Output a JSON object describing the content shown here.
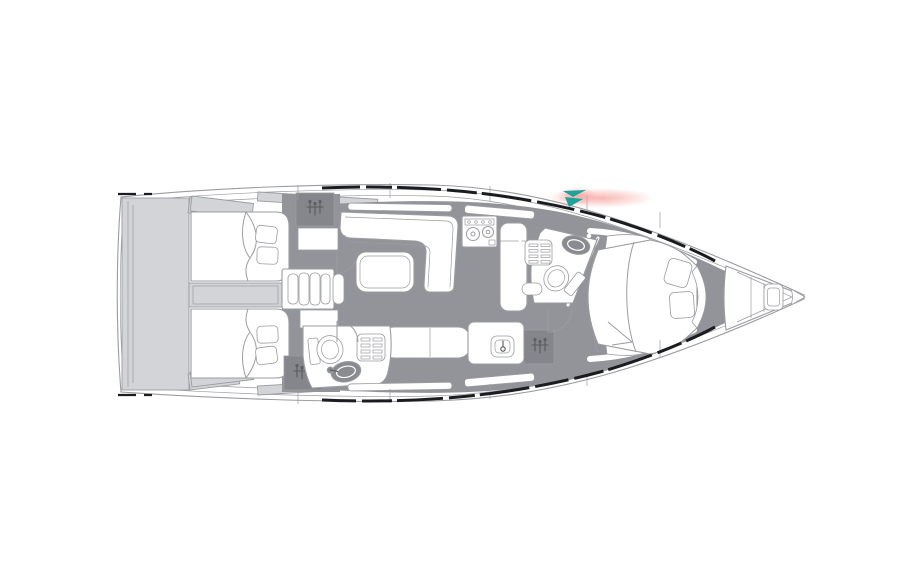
{
  "meta": {
    "title": "Sailing yacht interior floor plan",
    "view": "top-down deck plan, bow pointing right"
  },
  "colors": {
    "background": "#FFFFFF",
    "outline": "#9B9CA1",
    "deck": "#D3D4D8",
    "interior": "#939499",
    "cabinet": "#85868C",
    "sinkdark": "#8A8B90",
    "sheer": "#1B1C1F",
    "teal": "#1CA49B",
    "glow": "#F59E97",
    "iconink": "#595A5F"
  },
  "legend": {
    "rooms": [
      {
        "id": "stern-platform",
        "label": "Stern swim platform"
      },
      {
        "id": "aft-cabin-port",
        "label": "Aft cabin port with double berth"
      },
      {
        "id": "aft-cabin-starboard",
        "label": "Aft cabin starboard with double berth"
      },
      {
        "id": "companionway",
        "label": "Companionway steps"
      },
      {
        "id": "salon",
        "label": "Salon with L-settee and table"
      },
      {
        "id": "galley",
        "label": "Galley with stove, sink and counters"
      },
      {
        "id": "aft-head",
        "label": "Aft head with toilet, sink and shower seat"
      },
      {
        "id": "forward-head",
        "label": "Forward head with toilet, sink and shower seat"
      },
      {
        "id": "forward-cabin",
        "label": "Forward cabin with island berth"
      },
      {
        "id": "bow-locker",
        "label": "Bow anchor locker with windlass"
      }
    ],
    "icons": [
      "hanger-icon",
      "stove-icon",
      "sink-icon",
      "toilet-icon",
      "shower-grate-icon",
      "windlass-icon",
      "nav-arrow-marker-icon"
    ]
  },
  "marker": {
    "name": "nav-arrow-marker",
    "style": "teal double-chevron with coral glow on the sheer line near the bow"
  }
}
